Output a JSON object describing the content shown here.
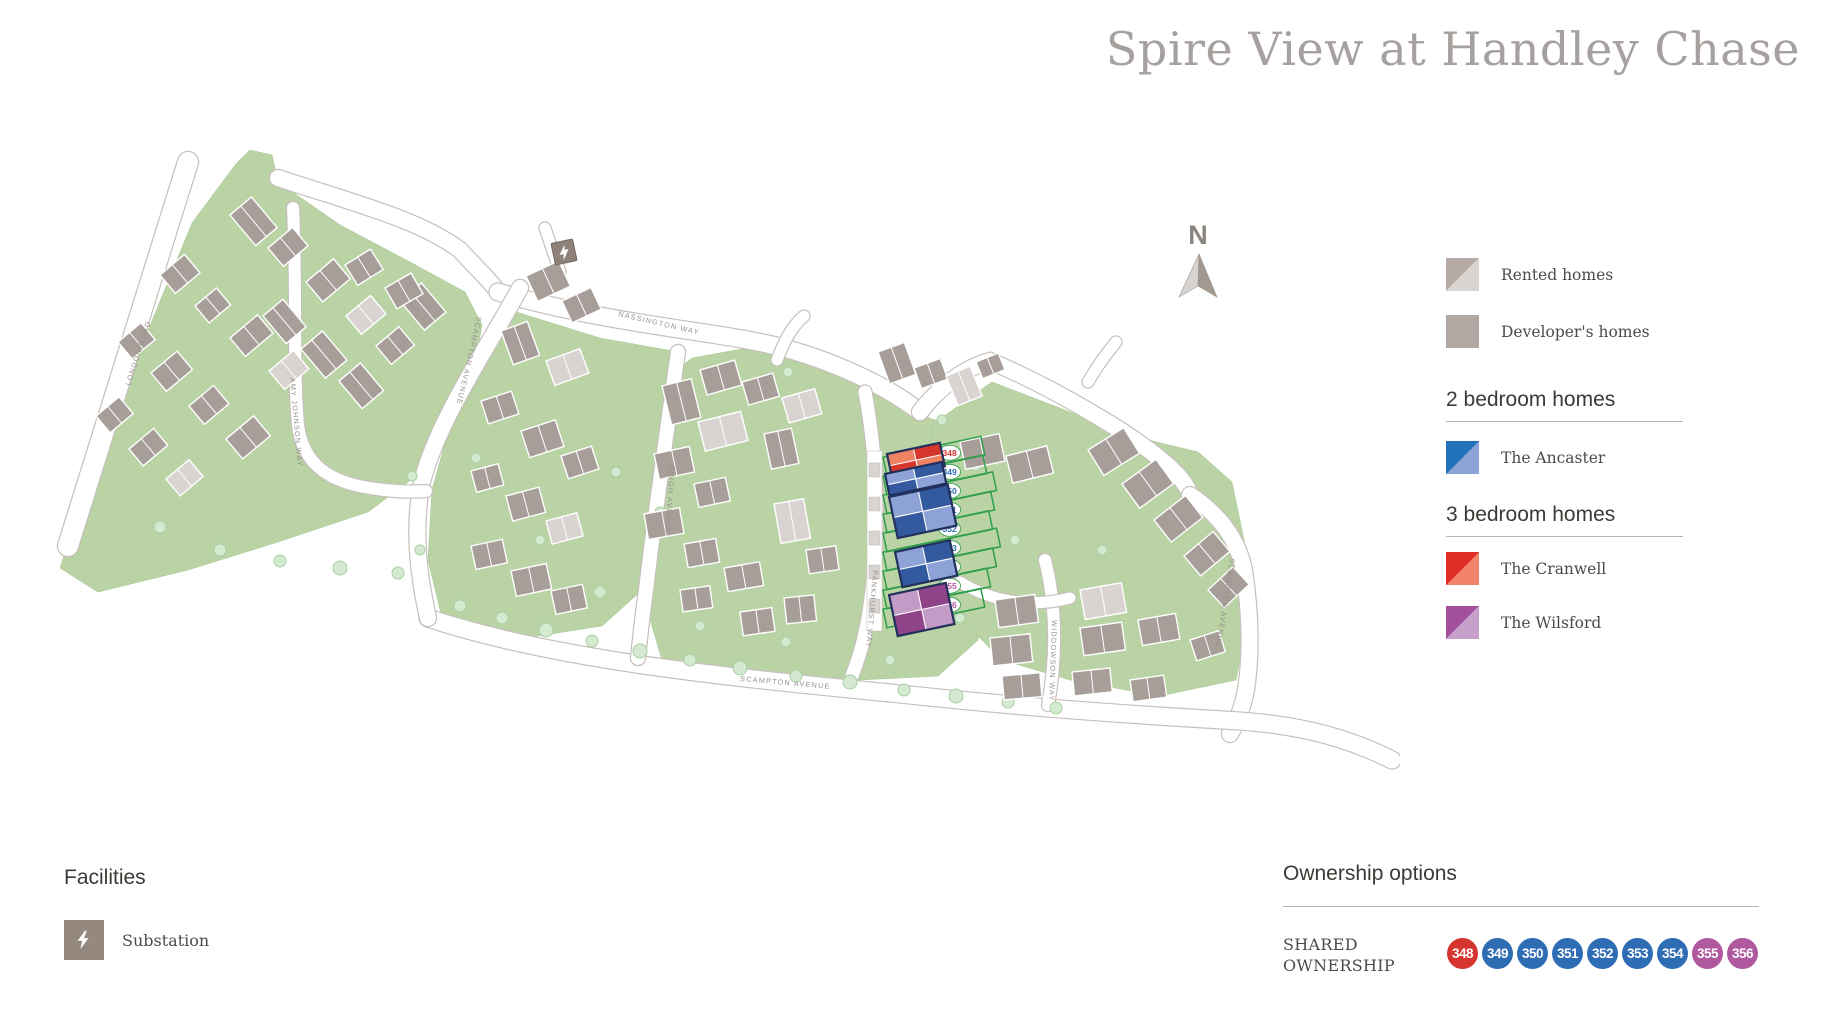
{
  "title": "Spire View at Handley Chase",
  "north_indicator": "N",
  "legend": {
    "rented_label": "Rented homes",
    "developer_label": "Developer's homes",
    "two_bed_heading": "2 bedroom homes",
    "ancaster_label": "The Ancaster",
    "three_bed_heading": "3 bedroom homes",
    "cranwell_label": "The Cranwell",
    "wilsford_label": "The Wilsford"
  },
  "colors": {
    "rented_dark": "#b5aba4",
    "rented_light": "#dad5d1",
    "developer": "#b2a8a3",
    "ancaster_dark": "#2273b9",
    "ancaster_light": "#8ca3d8",
    "cranwell_dark": "#e02d24",
    "cranwell_light": "#f0836a",
    "wilsford_dark": "#a3519c",
    "wilsford_light": "#c79fcb",
    "map_green": "#b9d3a5",
    "plot_outline_green": "#2f9e49"
  },
  "facilities": {
    "heading": "Facilities",
    "substation_label": "Substation"
  },
  "ownership": {
    "heading": "Ownership options",
    "category_lines": [
      "SHARED",
      "OWNERSHIP"
    ],
    "plots": [
      {
        "number": "348",
        "color": "#d6342e"
      },
      {
        "number": "349",
        "color": "#2e6db4"
      },
      {
        "number": "350",
        "color": "#2e6db4"
      },
      {
        "number": "351",
        "color": "#2e6db4"
      },
      {
        "number": "352",
        "color": "#2e6db4"
      },
      {
        "number": "353",
        "color": "#2e6db4"
      },
      {
        "number": "354",
        "color": "#2e6db4"
      },
      {
        "number": "355",
        "color": "#b0599f"
      },
      {
        "number": "356",
        "color": "#b0599f"
      }
    ]
  },
  "map": {
    "streets": [
      "LONDON ROAD",
      "AMY JOHNSON WAY",
      "SCAMPTON AVENUE",
      "NASSINGTON WAY",
      "SINGH AVENUE",
      "PANKHURST WAY",
      "WIDDOWSON WAY",
      "SCAMPTON AVENUE",
      "SCAMPTON AVENUE"
    ]
  }
}
